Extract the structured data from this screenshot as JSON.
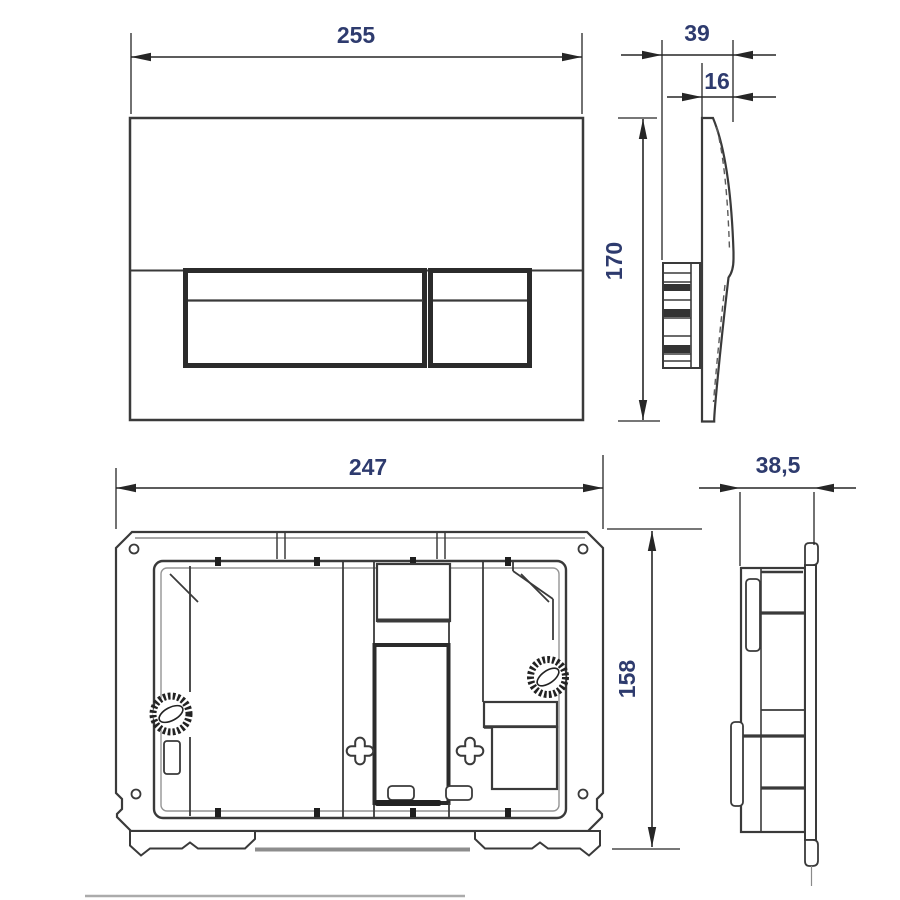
{
  "drawing": {
    "type": "technical-dimension-drawing",
    "subject": "flush plate and mounting frame, four orthographic views with millimetre dimensions",
    "colors": {
      "background": "#ffffff",
      "line": "#3a3a3a",
      "line_heavy": "#262626",
      "dimension_line": "#262626",
      "dimension_text": "#2e3b6e",
      "shadow": "#8d8d8d"
    },
    "views": {
      "plate_front": {
        "name": "flush plate front view",
        "width_label": "255",
        "height_label": "170"
      },
      "plate_side": {
        "name": "flush plate side view",
        "depth_label": "39",
        "thickness_label": "16"
      },
      "frame_front": {
        "name": "mounting frame front view",
        "width_label": "247",
        "height_label": "158"
      },
      "frame_side": {
        "name": "mounting frame side view",
        "depth_label": "38,5"
      }
    }
  }
}
